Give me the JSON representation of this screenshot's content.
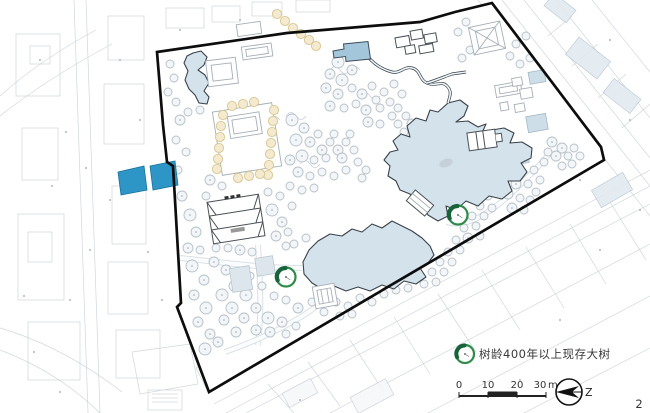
{
  "page_number": "2",
  "legend": {
    "label": "树龄400年以上现存大树",
    "marker": {
      "x": 465,
      "y": 354,
      "r": 9
    }
  },
  "scale_bar": {
    "labels": [
      "0",
      "10",
      "20",
      "30"
    ],
    "unit": "m"
  },
  "compass": {
    "label": "Z"
  },
  "heritage_trees": [
    {
      "x": 458,
      "y": 215,
      "r": 9.5
    },
    {
      "x": 286,
      "y": 277,
      "r": 9.5
    }
  ],
  "colors": {
    "water": "#d4e2ec",
    "accent": "#2e96c6",
    "heritage_green": "#2e8b4a",
    "heritage_dark": "#18643a",
    "boundary": "#0d0d0d",
    "fabric": "#c9cfd6",
    "beige_fill": "#f3ead0",
    "beige_stroke": "#d8c690"
  }
}
